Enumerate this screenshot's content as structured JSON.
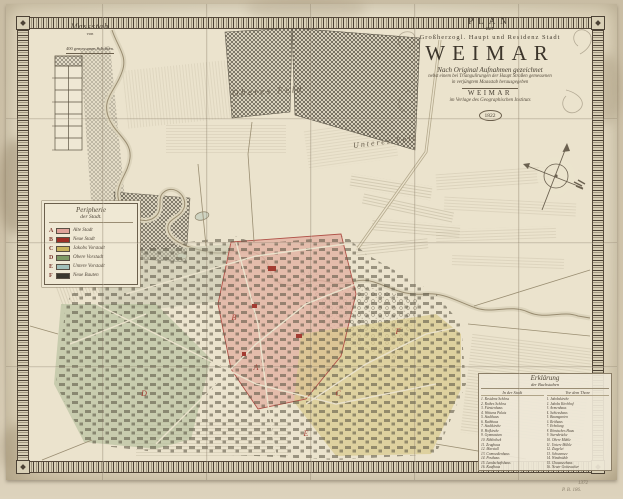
{
  "title_cartouche": {
    "line1": "PLAN",
    "line2": "der",
    "line3": "Großherzogl. Haupt und Residenz Stadt",
    "name": "WEIMAR",
    "sub1": "Nach Original Aufnahmen gezeichnet",
    "sub2": "nebst einem bei Triangulirungen der Haupt Straßen gemessenen",
    "sub3": "in verjüngtem Maasstab herausgegeben",
    "place": "WEIMAR",
    "publisher": "im Verlage des Geographischen Instituts",
    "year": "1822"
  },
  "scale_bar": {
    "title": "Massstab",
    "von": "von",
    "subtitle": "400 gemessenen Schritten."
  },
  "legend": {
    "title1": "Peripherie",
    "title2": "der Stadt.",
    "entries": [
      {
        "letter": "A",
        "color": "#dfa39a",
        "label": "Alte Stadt"
      },
      {
        "letter": "B",
        "color": "#9e2f26",
        "label": "Neue Stadt"
      },
      {
        "letter": "C",
        "color": "#c8b35e",
        "label": "Jakobs Vorstadt"
      },
      {
        "letter": "D",
        "color": "#7f9a66",
        "label": "Obere Vorstadt"
      },
      {
        "letter": "E",
        "color": "#a3c0ba",
        "label": "Untere Vorstadt"
      },
      {
        "letter": "F",
        "color": "#3a372e",
        "label": "Neue Bauten"
      }
    ]
  },
  "map_labels": {
    "field1": "Oberes Feld",
    "field2": "Unteres Feld"
  },
  "explanation_list": {
    "title": "Erklärung",
    "subtitle": "der Buchstaben",
    "col1_header": "In der Stadt",
    "col2_header": "Vor dem Thore",
    "col1": [
      "1. Residenz Schloss",
      "2. Rothes Schloss",
      "3. Fürstenhaus",
      "4. Wittums Palais",
      "5. Stadthaus",
      "6. Rathhaus",
      "7. Stadtkirche",
      "8. Hofkirche",
      "9. Gymnasium",
      "10. Bibliothek",
      "11. Zeughaus",
      "12. Marstall",
      "13. Comoedienhaus",
      "14. Posthaus",
      "15. Landschaftshaus",
      "16. Kaufhaus",
      "17. Hospital"
    ],
    "col2": [
      "1. Jakobskirche",
      "2. Jakobs Kirchhof",
      "3. Armenhaus",
      "4. Schiesshaus",
      "5. Baumgarten",
      "6. Reithaus",
      "7. Erholung",
      "8. Römisches Haus",
      "9. Sternbrücke",
      "10. Obere Mühle",
      "11. Untere Mühle",
      "12. Ziegelei",
      "13. Schwansee",
      "14. Windmühle",
      "15. Chausseehaus",
      "16. Neuer Gottesacker",
      "17. Galgenberg"
    ]
  },
  "margin_notes": {
    "note1": "1372",
    "note2": "P. B. 186."
  },
  "colors": {
    "paper": "#e9e1cb",
    "ink": "#4a4136",
    "border_band": "#4c4235",
    "district_letter_red": "#a33c32",
    "river": "#998c70",
    "forest": "#3f3a2f",
    "backdrop": "#cfc3aa"
  }
}
